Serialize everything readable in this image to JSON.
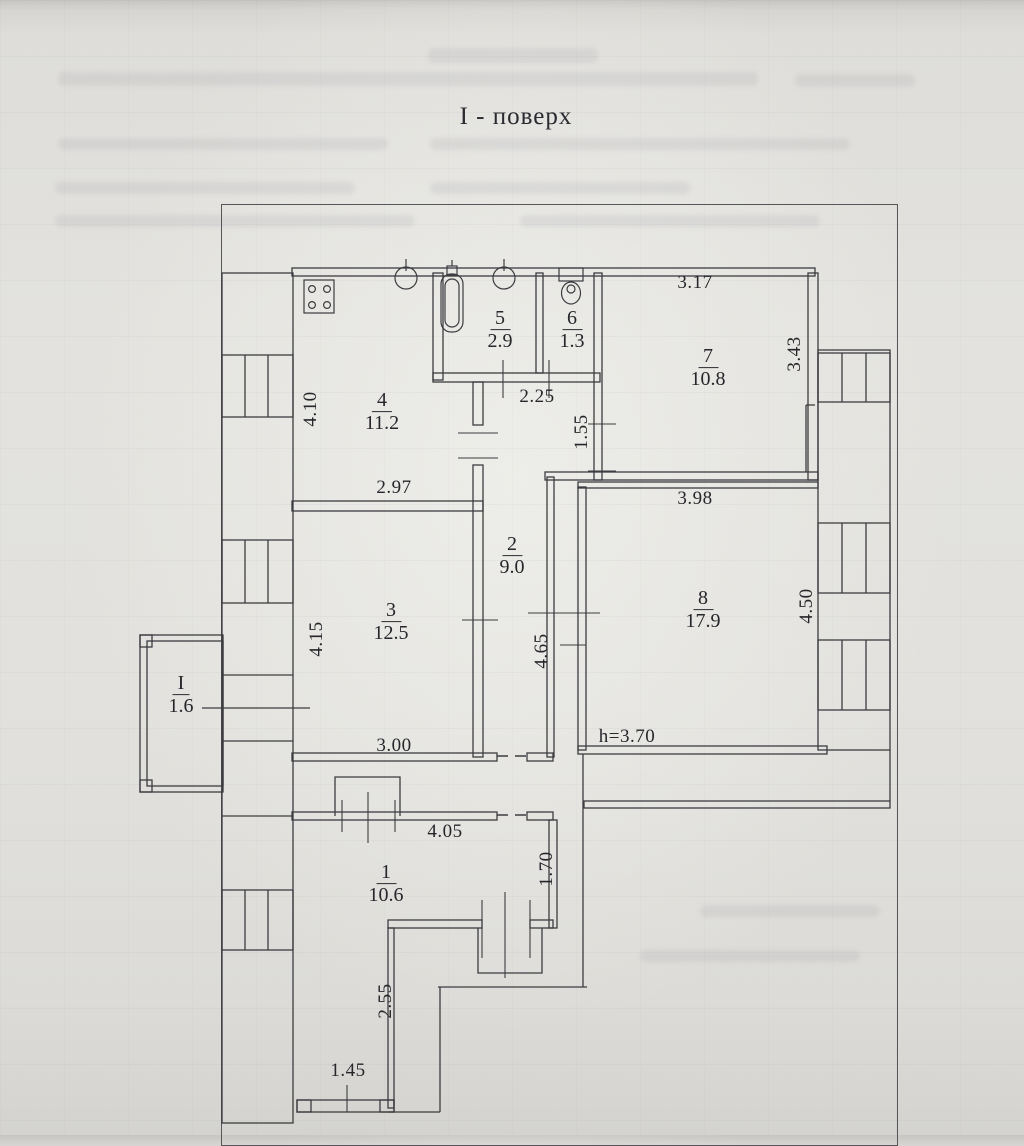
{
  "title": "I - поверх",
  "rooms": {
    "r1": {
      "number": "1",
      "area": "10.6"
    },
    "r2": {
      "number": "2",
      "area": "9.0"
    },
    "r3": {
      "number": "3",
      "area": "12.5"
    },
    "r4": {
      "number": "4",
      "area": "11.2"
    },
    "r5": {
      "number": "5",
      "area": "2.9"
    },
    "r6": {
      "number": "6",
      "area": "1.3"
    },
    "r7": {
      "number": "7",
      "area": "10.8"
    },
    "r8": {
      "number": "8",
      "area": "17.9"
    },
    "balcony": {
      "number": "I",
      "area": "1.6"
    }
  },
  "dimensions": {
    "room7_top": "3.17",
    "room7_right": "3.43",
    "room4_left": "4.10",
    "bath_passage": "2.25",
    "hall_top_right": "1.55",
    "room4_bottom": "2.97",
    "room8_top": "3.98",
    "room3_left": "4.15",
    "hall_middle": "4.65",
    "room8_right": "4.50",
    "room3_bottom": "3.00",
    "ceiling_height": "h=3.70",
    "room1_top": "4.05",
    "room1_right": "1.70",
    "porch_right": "2.55",
    "porch_bottom": "1.45"
  },
  "colors": {
    "ink": "#3c3c41",
    "paper": "#e3e2de"
  }
}
